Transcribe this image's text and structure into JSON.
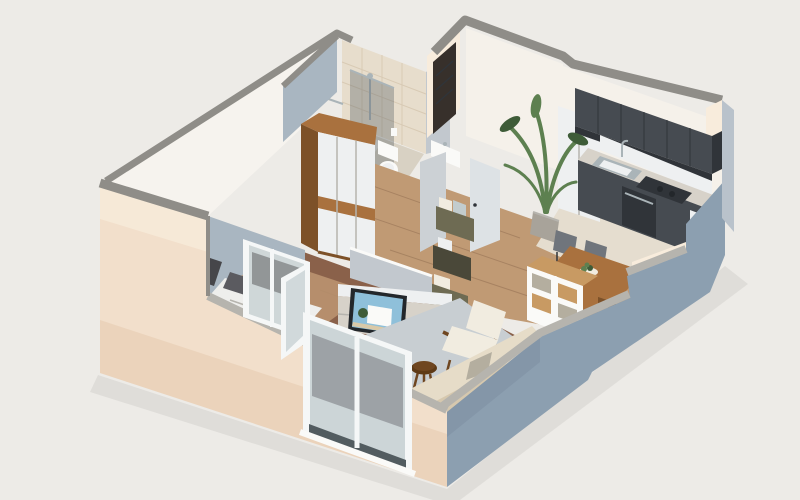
{
  "scene": {
    "title": "Isometric 3D cutaway render of a studio apartment",
    "description": "Axonometric dollhouse view of a small studio apartment: bathroom with tiled shower at the back left, wooden wardrobe, entry hall with dark front door and open white doors, kitchen with dark charcoal cabinets along the back right wall, dining table with chairs and cube shelf, living area with TV sideboard, white armchair, beige sofa, round stool and rug, sleeping alcove with bed, and white window frames with a balcony door on the cream exterior wall.",
    "rooms": [
      "bathroom",
      "entry-hall",
      "kitchen",
      "dining-area",
      "living-room",
      "sleeping-alcove"
    ],
    "furniture": [
      "wardrobe",
      "bed",
      "tv-sideboard",
      "tv",
      "magazine-crates",
      "potted-palm",
      "dining-table",
      "dining-chairs",
      "cube-shelf",
      "armchair",
      "sofa",
      "stool",
      "rug",
      "kitchen-cabinets",
      "sink",
      "cooktop",
      "oven",
      "toilet",
      "washbasin",
      "shower"
    ],
    "palette": {
      "bg": "#edebe7",
      "groundShadow": "#000000",
      "slab": "#f6f3ee",
      "capGray": "#8f8d88",
      "capLight": "#b6b4ae",
      "cream": "#f2dfcb",
      "creamLight": "#f8ecdc",
      "creamDark": "#e3c5a8",
      "blue": "#8c9fb0",
      "blueLight": "#b9c2cb",
      "blueDark": "#75879a",
      "intWhite": "#f5f1ea",
      "intShadow": "#c2c8ce",
      "blueGrayWall": "#a9b6c1",
      "tile": "#e7ddcc",
      "tileLine": "#d2c2aa",
      "floorHall": "#c09a74",
      "floorLiving": "#8a614a",
      "floorKitchen": "#e5ddcf",
      "floorBath": "#d8d1c3",
      "plank": "#5f3f2c",
      "rug": "#c8ced2",
      "wood": "#a9713e",
      "woodDark": "#7d5128",
      "woodLight": "#c89a63",
      "white": "#fafaf8",
      "offWhite": "#eef0f1",
      "doorDark": "#37302b",
      "cabinet": "#464b51",
      "cabinetDark": "#303439",
      "counter": "#d7d2c9",
      "steel": "#aab4b8",
      "glass": "#c2ccce",
      "glassDark": "#525c60",
      "frame": "#f5f7f7",
      "plant": "#5d8050",
      "plantDark": "#3e5c38",
      "pot": "#a8a39a",
      "sofa": "#d6c8ae",
      "sofaLight": "#e6dcc8",
      "cushionWhite": "#f1ece0",
      "cushionGray": "#b4ae9f",
      "tv": "#23272b",
      "sky": "#8fc0da",
      "sand": "#d9c9a8",
      "bed": "#eeeeec",
      "pillow": "#5b5b60",
      "pillow2": "#6e6e74",
      "case": "#46464a",
      "crate": "#6e6b53",
      "crateDark": "#4a4839",
      "stool": "#6f4620",
      "stoolTop": "#5e3a16",
      "grayDoor": "#ccd1d5",
      "grayDoor2": "#dde2e5",
      "chairGray": "#70757c"
    }
  }
}
